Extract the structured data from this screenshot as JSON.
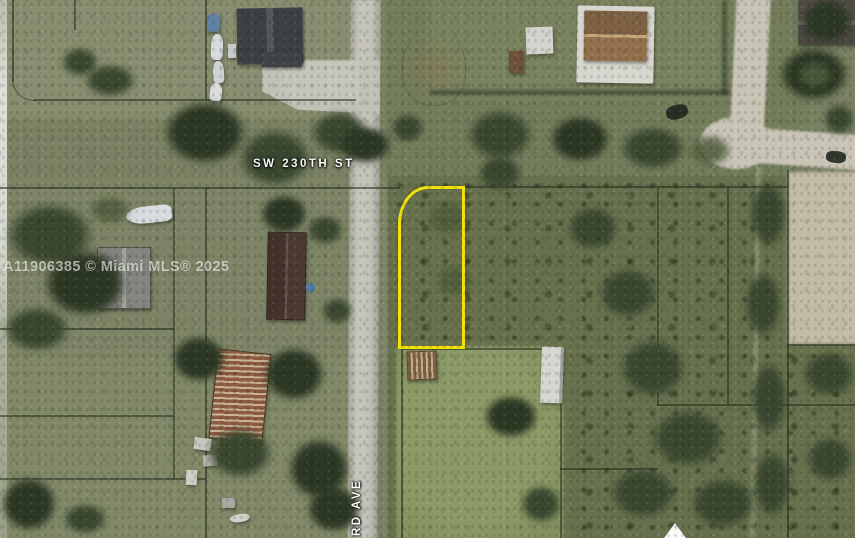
{
  "image": {
    "kind": "aerial-mls-photo",
    "description": "Satellite aerial view of residential acreage parcels with a vacant lot outlined in yellow"
  },
  "watermark": {
    "text": "A11906385 © Miami MLS® 2025"
  },
  "labels": {
    "street_horizontal": "SW 230TH ST",
    "street_vertical": "RD AVE"
  },
  "boundary": {
    "shape": "rounded-top-left-rectangle",
    "color": "#f2e40a"
  },
  "marker": {
    "shape": "triangle-up",
    "color": "#fafaf7"
  },
  "palette": {
    "grass": "#7b8263",
    "grass_light": "#888e6f",
    "field_mid": "#7e8566",
    "field_bottom": "#818968",
    "field_ne": "#747d5b",
    "yard_tr": "#7a835f",
    "lawn": "#83915f",
    "scrub": "#68714e",
    "canopy_dark": "#2c3824",
    "canopy": "#3a4830",
    "canopy_light": "#4f5c3c",
    "road": "#bdbbb0",
    "dirt_road": "#c8c4b6",
    "clearing": "#c4bba6",
    "boundary": "#f2e40a",
    "label_text": "#fcfcf8",
    "watermark_text": "rgba(255,255,255,0.60)"
  }
}
